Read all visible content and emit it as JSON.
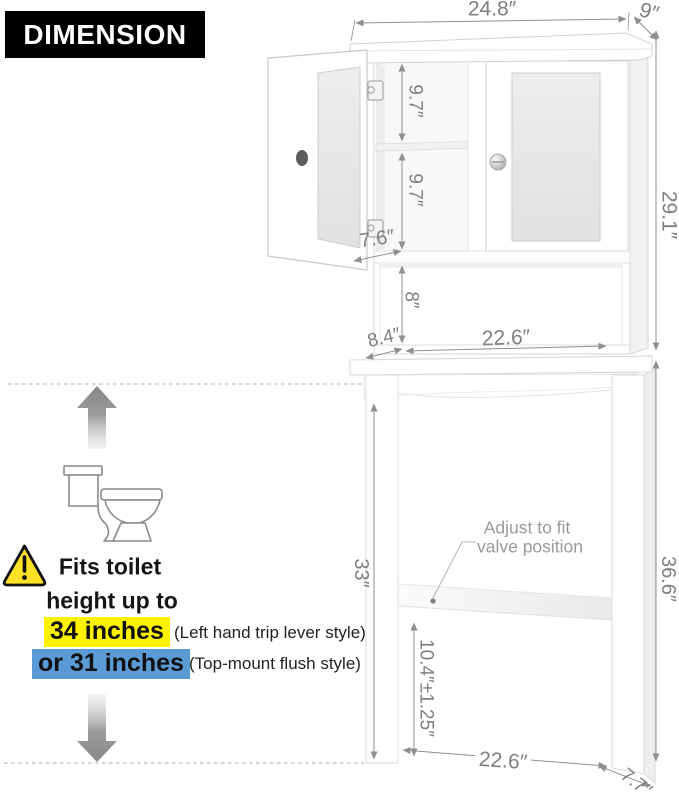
{
  "header": {
    "title": "DIMENSION"
  },
  "colors": {
    "header_bg": "#000000",
    "highlight_yellow": "#fff200",
    "highlight_blue": "#5b9bd5",
    "warning_yellow": "#ffe226",
    "dimension_text": "#7f7f7f",
    "note_text": "#9a9a9a",
    "cabinet_outline": "#d5d5d5"
  },
  "icons": {
    "warning": "warning-triangle",
    "toilet": "toilet-side-view",
    "arrow_up": "up-arrow",
    "arrow_down": "down-arrow"
  },
  "dimensions": {
    "top_width": "24.8″",
    "top_depth": "9″",
    "hutch_height": "29.1″",
    "shelf_upper": "9.7″",
    "shelf_lower": "9.7″",
    "door_width": "7.6″",
    "cubby_height": "8″",
    "cubby_depth": "8.4″",
    "cubby_width": "22.6″",
    "stand_inner_height": "33″",
    "total_height": "36.6″",
    "crossbar_to_floor": "10.4″±1.25″",
    "base_inner_width": "22.6″",
    "base_depth": "7.7″"
  },
  "annotations": {
    "valve_note_line1": "Adjust to fit",
    "valve_note_line2": "valve position"
  },
  "fit_info": {
    "line1": "Fits toilet",
    "line2": "height up to",
    "option1_value": "34 inches",
    "option1_style": "(Left hand trip lever style)",
    "option2_value": "or 31 inches",
    "option2_style": "(Top-mount flush style)"
  }
}
